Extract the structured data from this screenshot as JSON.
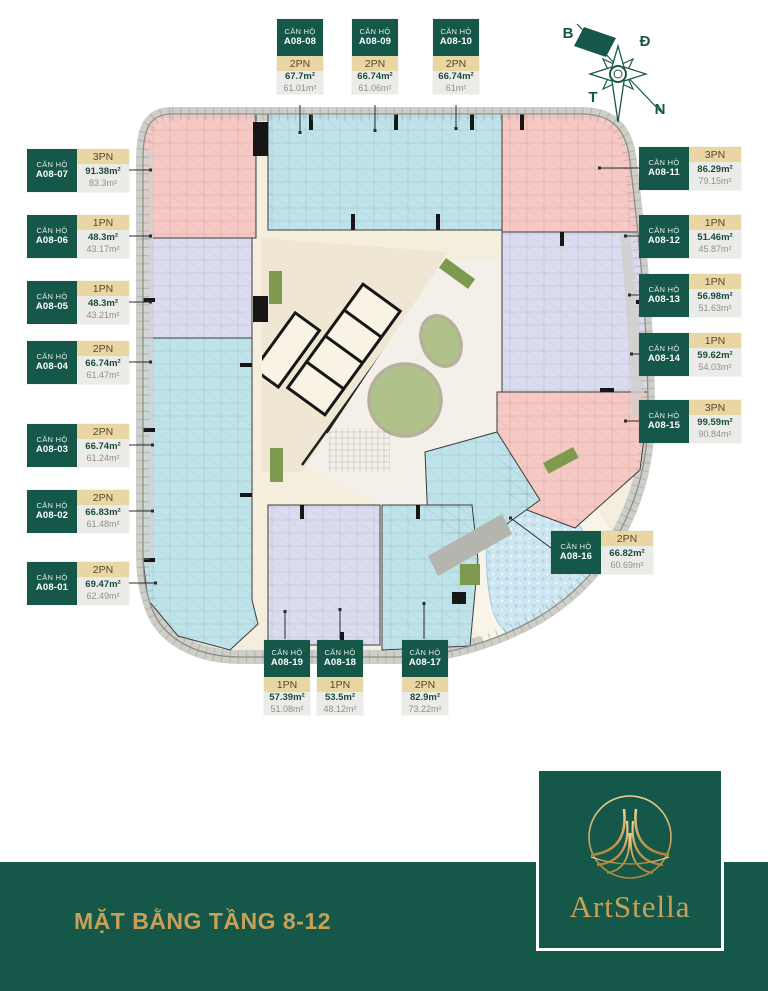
{
  "legend": {
    "unit_type_label": "CĂN HỘ"
  },
  "compass": {
    "north": "B",
    "east": "Đ",
    "west": "T",
    "south": "N"
  },
  "units": [
    {
      "id": "A08-01",
      "bedrooms": "2PN",
      "gross_area": "69.47m²",
      "net_area": "62.49m²"
    },
    {
      "id": "A08-02",
      "bedrooms": "2PN",
      "gross_area": "66.83m²",
      "net_area": "61.48m²"
    },
    {
      "id": "A08-03",
      "bedrooms": "2PN",
      "gross_area": "66.74m²",
      "net_area": "61.24m²"
    },
    {
      "id": "A08-04",
      "bedrooms": "2PN",
      "gross_area": "66.74m²",
      "net_area": "61.47m²"
    },
    {
      "id": "A08-05",
      "bedrooms": "1PN",
      "gross_area": "48.3m²",
      "net_area": "43.21m²"
    },
    {
      "id": "A08-06",
      "bedrooms": "1PN",
      "gross_area": "48.3m²",
      "net_area": "43.17m²"
    },
    {
      "id": "A08-07",
      "bedrooms": "3PN",
      "gross_area": "91.38m²",
      "net_area": "83.3m²"
    },
    {
      "id": "A08-08",
      "bedrooms": "2PN",
      "gross_area": "67.7m²",
      "net_area": "61.01m²"
    },
    {
      "id": "A08-09",
      "bedrooms": "2PN",
      "gross_area": "66.74m²",
      "net_area": "61.06m²"
    },
    {
      "id": "A08-10",
      "bedrooms": "2PN",
      "gross_area": "66.74m²",
      "net_area": "61m²"
    },
    {
      "id": "A08-11",
      "bedrooms": "3PN",
      "gross_area": "86.29m²",
      "net_area": "79.15m²"
    },
    {
      "id": "A08-12",
      "bedrooms": "1PN",
      "gross_area": "51.46m²",
      "net_area": "45.87m²"
    },
    {
      "id": "A08-13",
      "bedrooms": "1PN",
      "gross_area": "56.98m²",
      "net_area": "51.63m²"
    },
    {
      "id": "A08-14",
      "bedrooms": "1PN",
      "gross_area": "59.62m²",
      "net_area": "54.03m²"
    },
    {
      "id": "A08-15",
      "bedrooms": "3PN",
      "gross_area": "99.59m²",
      "net_area": "90.84m²"
    },
    {
      "id": "A08-16",
      "bedrooms": "2PN",
      "gross_area": "66.82m²",
      "net_area": "60.69m²"
    },
    {
      "id": "A08-17",
      "bedrooms": "2PN",
      "gross_area": "82.9m²",
      "net_area": "73.22m²"
    },
    {
      "id": "A08-18",
      "bedrooms": "1PN",
      "gross_area": "53.5m²",
      "net_area": "48.12m²"
    },
    {
      "id": "A08-19",
      "bedrooms": "1PN",
      "gross_area": "57.39m²",
      "net_area": "51.08m²"
    }
  ],
  "footer": {
    "title": "MẶT BẰNG TẦNG 8-12",
    "brand": "ArtStella"
  },
  "colors": {
    "accent_green": "#15584a",
    "gold": "#c8a157",
    "tan": "#ead6a2",
    "unit_pink": "#f7c9c5",
    "unit_blue": "#bfe3ea",
    "unit_lavender": "#dcdcf1",
    "corridor_beige": "#f5eedc",
    "lawn_green": "#aec289",
    "pool_blue": "#cde7f2"
  }
}
